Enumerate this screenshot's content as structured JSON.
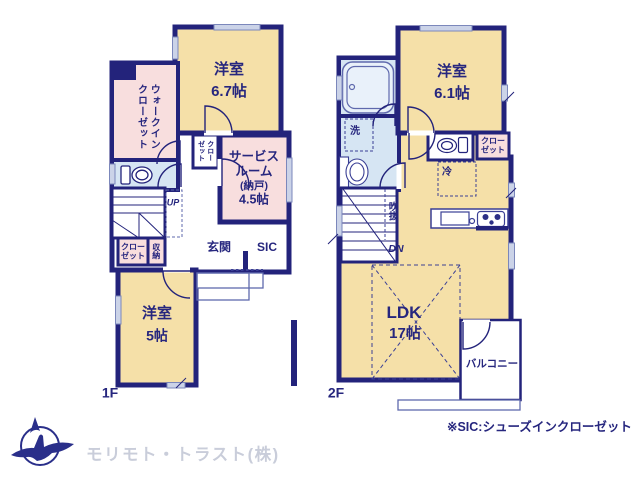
{
  "colors": {
    "wall_navy": "#23237b",
    "room_cream": "#f5e0a8",
    "room_pink": "#f8dede",
    "room_blue": "#d6e5f3",
    "window_fill": "#cbd3e8",
    "logo_text": "#c9cdda"
  },
  "f1": {
    "floor": "1F",
    "bedroom1_name": "洋室",
    "bedroom1_size": "6.7帖",
    "wic_line1": "ウォークイン",
    "wic_line2": "クローゼット",
    "closet_mid_line1": "クロー",
    "closet_mid_line2": "ゼット",
    "service_line1": "サービス",
    "service_line2": "ルーム",
    "service_line3": "(納戸)",
    "service_line4": "4.5帖",
    "up": "UP",
    "closet_sw_line1": "クロー",
    "closet_sw_line2": "ゼット",
    "storage": "収納",
    "entrance": "玄関",
    "sic": "SIC",
    "bedroom2_name": "洋室",
    "bedroom2_size": "5帖"
  },
  "f2": {
    "floor": "2F",
    "wash": "洗",
    "bedroom_name": "洋室",
    "bedroom_size": "6.1帖",
    "closet_line1": "クロー",
    "closet_line2": "ゼット",
    "fridge": "冷",
    "void_label": "吹抜",
    "dn": "DN",
    "ldk_name": "LDK",
    "ldk_size": "17帖",
    "balcony": "バルコニー"
  },
  "footer": {
    "note": "※SIC:シューズインクローゼット",
    "company": "モリモト・トラスト(株)"
  }
}
